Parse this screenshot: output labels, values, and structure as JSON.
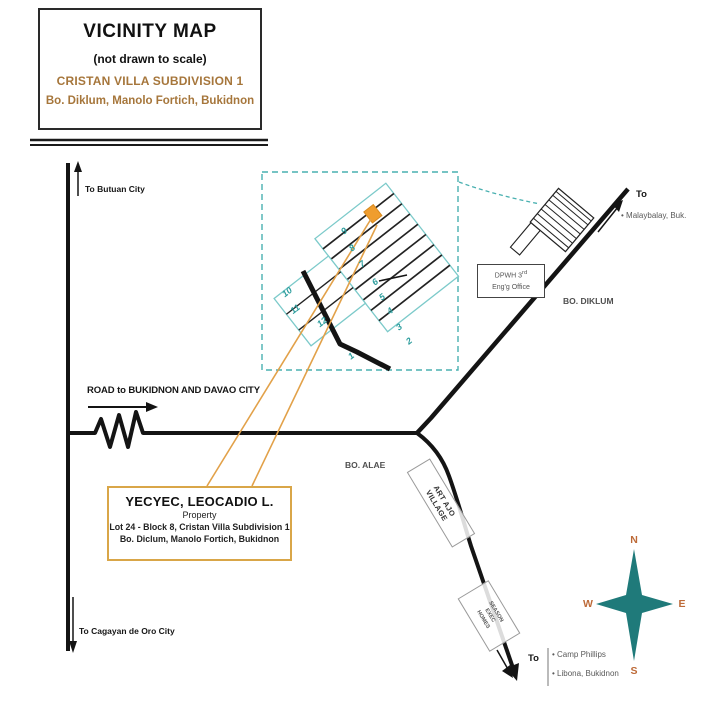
{
  "title_box": {
    "title": "VICINITY MAP",
    "subtitle": "(not drawn to scale)",
    "subdivision_name": "CRISTAN VILLA SUBDIVISION 1",
    "location": "Bo. Diklum, Manolo Fortich, Bukidnon"
  },
  "road_labels": {
    "to_butuan": "To Butuan  City",
    "to_cagayan": "To  Cagayan de Oro City",
    "main_road": "ROAD to BUKIDNON AND DAVAO CITY",
    "to_ne": "To",
    "to_ne_dest": "•  Malaybalay, Buk.",
    "to_s": "To",
    "to_s_dest1": "•  Camp Phillips",
    "to_s_dest2": "•  Libona, Bukidnon"
  },
  "areas": {
    "bo_diklum": "BO. DIKLUM",
    "bo_alae": "BO. ALAE"
  },
  "landmarks": {
    "dpwh_line1_main": "DPWH 3",
    "dpwh_line1_sup": "rd",
    "dpwh_line2": "Eng'g Office",
    "art_ajo": [
      "ART AJO",
      "VILLAGE"
    ],
    "exec_homes": [
      "SEASON",
      "EXEC",
      "HOMES"
    ]
  },
  "property_box": {
    "owner": "YECYEC, LEOCADIO L.",
    "type": "Property",
    "lot_info": "Lot 24 - Block 8, Cristan Villa Subdivision 1",
    "address": "Bo. Diclum, Manolo Fortich, Bukidnon"
  },
  "subdivision_inset": {
    "block_numbers": [
      "9",
      "8",
      "7",
      "6",
      "5",
      "4",
      "3",
      "2",
      "1",
      "10",
      "11",
      "12"
    ]
  },
  "compass": {
    "north": "N",
    "east": "E",
    "south": "S",
    "west": "W"
  },
  "colors": {
    "brown_text": "#a6763b",
    "orange_accent": "#e2a149",
    "lot_fill": "#ef9d2e",
    "teal_outline": "#7ccaca",
    "teal_dashed": "#49b0b0",
    "teal_numbers": "#2d9d9d",
    "compass_teal": "#1f7a7a",
    "gray_text": "#555555",
    "road_black": "#141414"
  }
}
